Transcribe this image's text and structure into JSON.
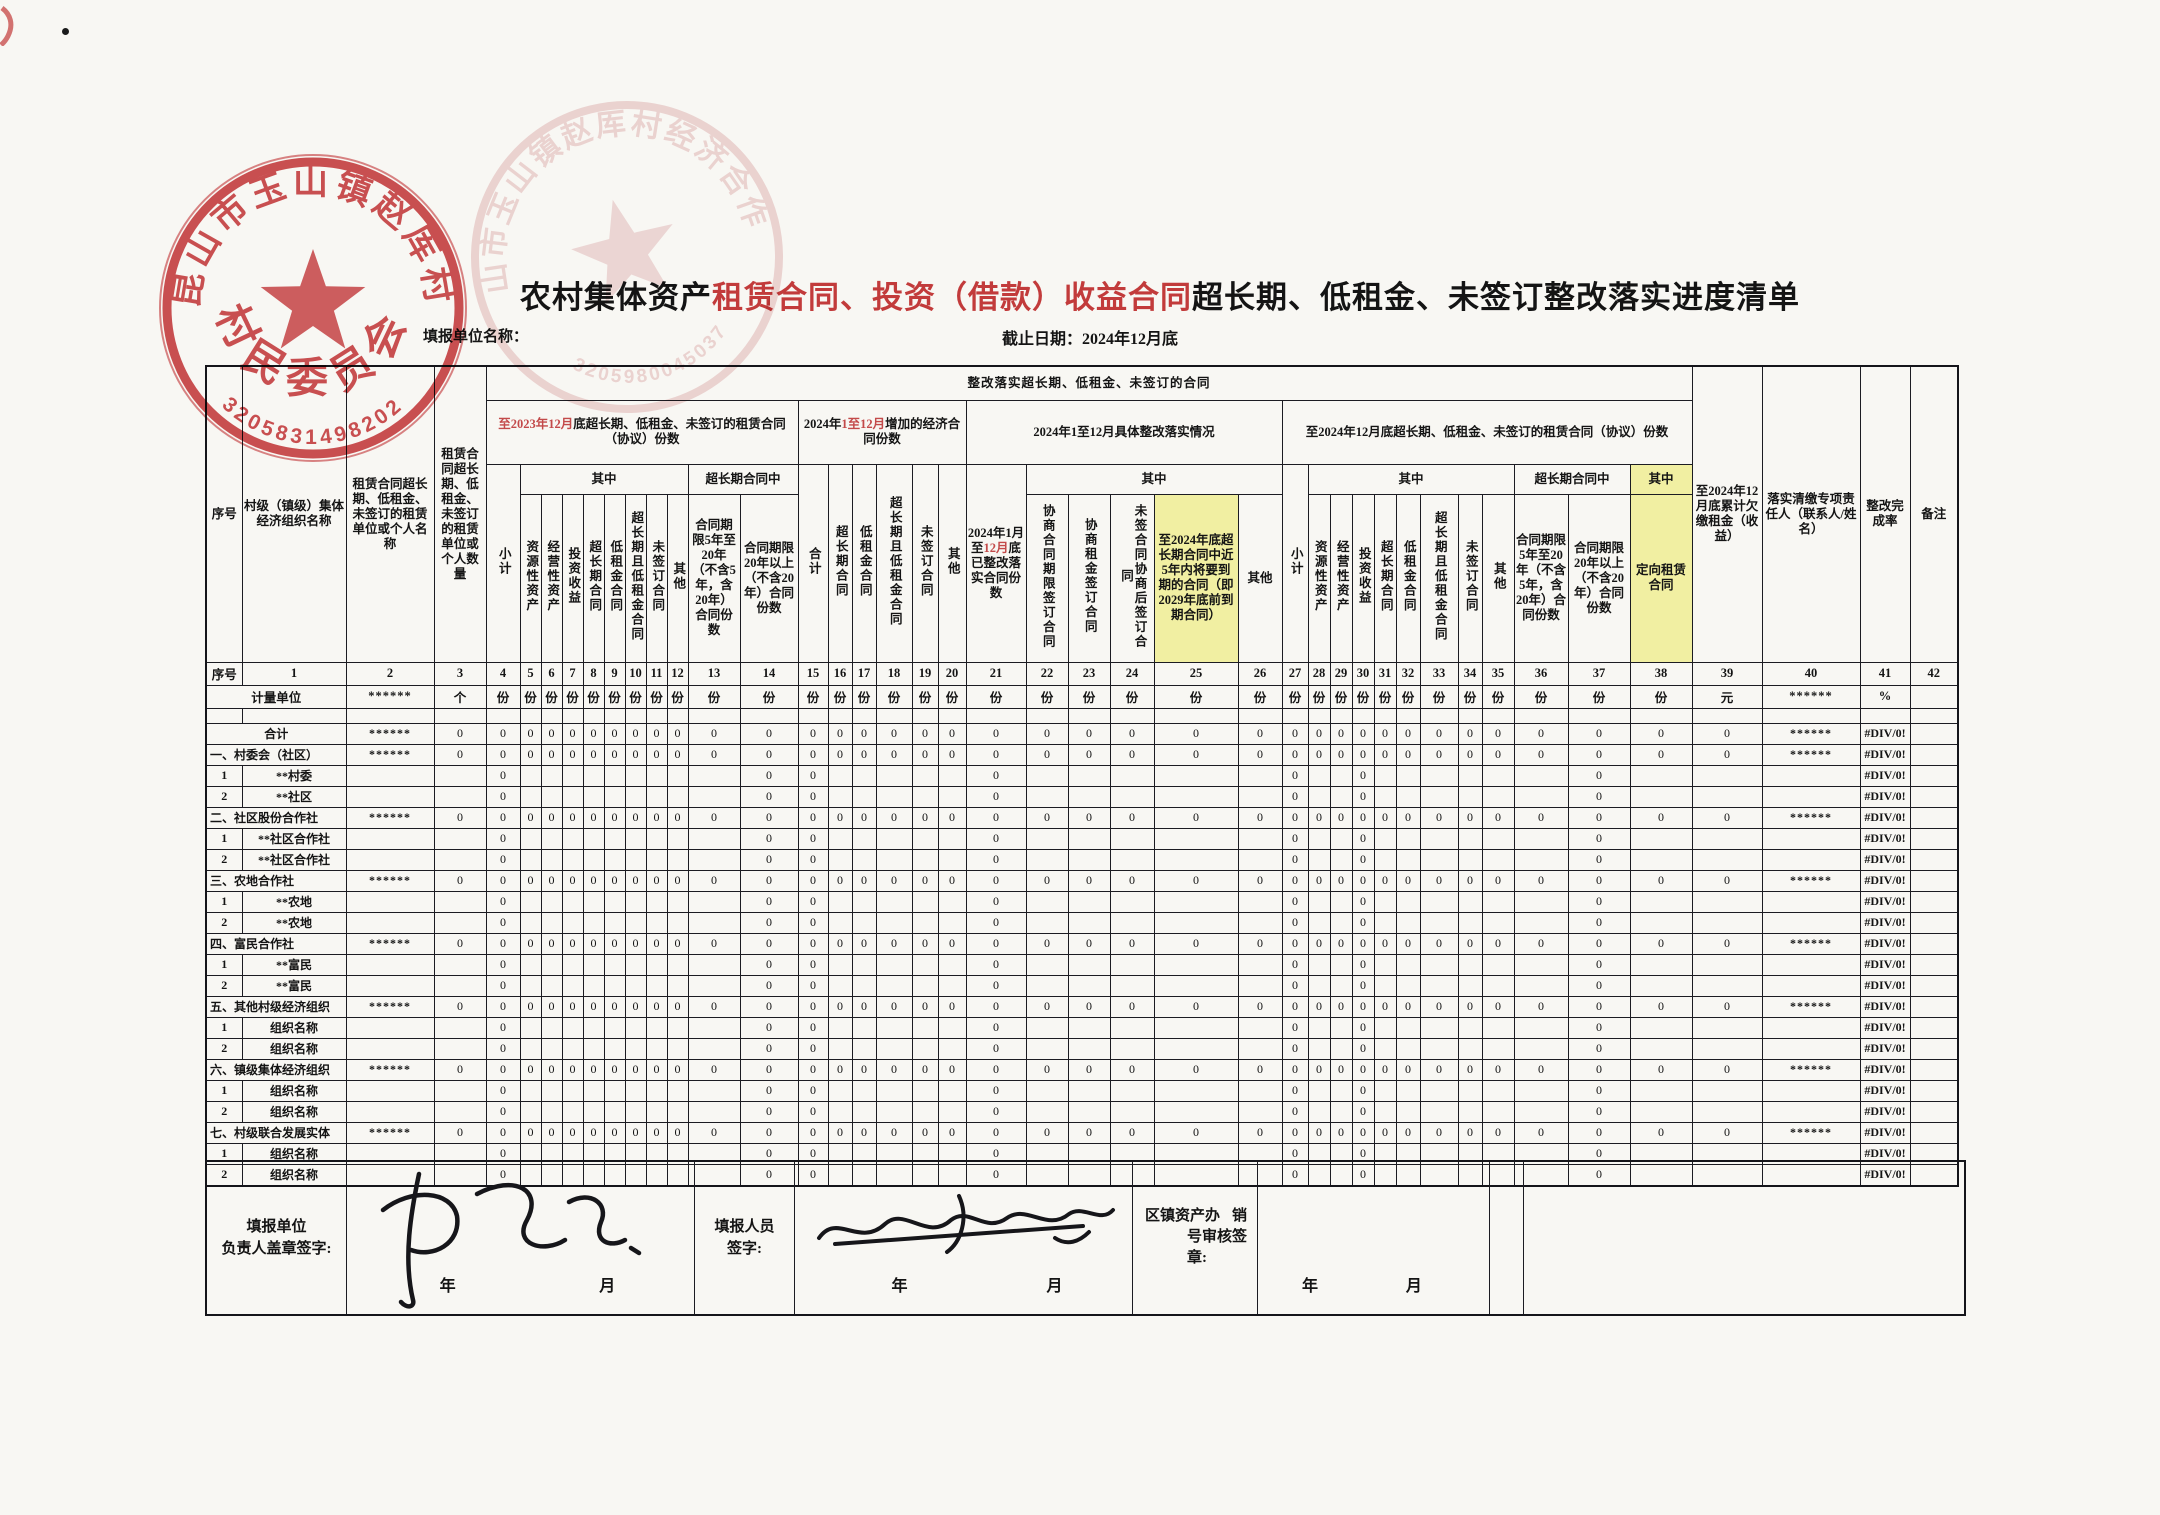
{
  "colors": {
    "stamp_red": "#c8393c",
    "accent_red": "#c23b3b",
    "pink_value": "#bf5a68",
    "highlight_yellow": "#f1efa2"
  },
  "form_header": {
    "unit_name_label": "填报单位名称：",
    "title_prefix": "农村集体资产",
    "title_red": "租赁合同、投资（借款）收益合同",
    "title_suffix": "超长期、低租金、未签订整改落实进度清单",
    "deadline": "截止日期：2024年12月底"
  },
  "stamps": {
    "primary": {
      "ring_text": "昆山市玉山镇赵厍村",
      "center_text": "村民委员会",
      "code": "3205831498202"
    },
    "secondary": {
      "ring_text": "昆山市玉山镇赵厍村经济合作社",
      "code": "3205980045037"
    }
  },
  "table": {
    "top_header": "整改落实超长期、低租金、未签订的合同",
    "corner": {
      "seq": "序号",
      "col1": "村级（镇级）集体经济组织名称",
      "col2": "租赁合同超长期、低租金、未签订的租赁单位或个人名称",
      "col3": "租赁合同超长期、低租金、未签订的租赁单位或个人数量"
    },
    "right": {
      "col39": "至2024年12月底累计欠缴租金（收益）",
      "col40": "落实清缴专项责任人（联系人/姓名）",
      "col41": "整改完成率",
      "col42": "备注"
    },
    "shared": {
      "xiaoji": "小计",
      "qizhong": "其中",
      "overlong_mid": "超长期合同中",
      "dur_5_20": "合同期限5年至20年（不含5年，含20年）合同份数",
      "dur_20plus": "合同期限20年以上（不含20年）合同份数",
      "leaves": [
        "资源性资产",
        "经营性资产",
        "投资收益",
        "超长期合同",
        "低租金合同",
        "超长期且低租金合同",
        "未签订合同",
        "其他"
      ]
    },
    "groups": {
      "g1": {
        "title_red": "至2023年12月",
        "title_rest": "底超长期、低租金、未签订的租赁合同（协议）份数"
      },
      "g2": {
        "title_pre": "2024年",
        "title_red": "1至12月",
        "title_rest": "增加的经济合同份数",
        "leaves": [
          "合计",
          "超长期合同",
          "低租金合同",
          "超长期且低租金合同",
          "未签订合同",
          "其他"
        ]
      },
      "g3": {
        "title": "2024年1至12月具体整改落实情况",
        "col21_pre": "2024年1月至",
        "col21_red": "12月",
        "col21_rest": "底已整改落实合同份数",
        "leaves": [
          "协商合同期限签订合同",
          "协商租金签订合同",
          "未签合同协商后签订合同",
          "至2024年底超长期合同中近5年内将要到期的合同（即2029年底前到期合同）",
          "其他"
        ]
      },
      "g4": {
        "title": "至2024年12月底超长期、低租金、未签订的租赁合同（协议）份数",
        "qizhong2": "其中",
        "dingxiang": "定向租赁合同"
      }
    },
    "number_row": [
      "序号",
      "1",
      "2",
      "3",
      "4",
      "5",
      "6",
      "7",
      "8",
      "9",
      "10",
      "11",
      "12",
      "13",
      "14",
      "15",
      "16",
      "17",
      "18",
      "19",
      "20",
      "21",
      "22",
      "23",
      "24",
      "25",
      "26",
      "27",
      "28",
      "29",
      "30",
      "31",
      "32",
      "33",
      "34",
      "35",
      "36",
      "37",
      "38",
      "39",
      "40",
      "41",
      "42"
    ],
    "unit_row": {
      "label": "计量单位",
      "default_unit": "份",
      "values": {
        "2": "******",
        "3": "个",
        "39": "元",
        "40": "******",
        "41": "%",
        "42": ""
      }
    },
    "value_patterns": {
      "category": {
        "explicit": {
          "2": "******",
          "3": "0",
          "40": "******",
          "41": "#DIV/0!"
        },
        "zero_range": [
          4,
          39
        ],
        "zero": "0"
      },
      "sub": {
        "explicit": {
          "41": "#DIV/0!"
        },
        "zero_cols": [
          4,
          14,
          15,
          21,
          27,
          30,
          37
        ],
        "zero": "0"
      }
    },
    "rows": [
      {
        "type": "total",
        "name": "合计"
      },
      {
        "type": "cat",
        "name": "一、村委会（社区）"
      },
      {
        "type": "sub",
        "num": "1",
        "name": "**村委"
      },
      {
        "type": "sub",
        "num": "2",
        "name": "**社区"
      },
      {
        "type": "cat",
        "name": "二、社区股份合作社"
      },
      {
        "type": "sub",
        "num": "1",
        "name": "**社区合作社"
      },
      {
        "type": "sub",
        "num": "2",
        "name": "**社区合作社"
      },
      {
        "type": "cat",
        "name": "三、农地合作社"
      },
      {
        "type": "sub",
        "num": "1",
        "name": "**农地"
      },
      {
        "type": "sub",
        "num": "2",
        "name": "**农地"
      },
      {
        "type": "cat",
        "name": "四、富民合作社"
      },
      {
        "type": "sub",
        "num": "1",
        "name": "**富民"
      },
      {
        "type": "sub",
        "num": "2",
        "name": "**富民"
      },
      {
        "type": "cat",
        "name": "五、其他村级经济组织"
      },
      {
        "type": "sub",
        "num": "1",
        "name": "组织名称"
      },
      {
        "type": "sub",
        "num": "2",
        "name": "组织名称"
      },
      {
        "type": "cat",
        "name": "六、镇级集体经济组织"
      },
      {
        "type": "sub",
        "num": "1",
        "name": "组织名称"
      },
      {
        "type": "sub",
        "num": "2",
        "name": "组织名称"
      },
      {
        "type": "cat",
        "name": "七、村级联合发展实体"
      },
      {
        "type": "sub",
        "num": "1",
        "name": "组织名称"
      },
      {
        "type": "sub",
        "num": "2",
        "name": "组织名称"
      }
    ]
  },
  "footer": {
    "cell1_line1": "填报单位",
    "cell1_line2": "负责人盖章签字:",
    "cell3_line1": "填报人员",
    "cell3_line2": "签字:",
    "cell5_line1_left": "区镇资产办",
    "cell5_line1_right": "销",
    "cell5_line2": "号审核签章:",
    "year": "年",
    "month": "月"
  }
}
